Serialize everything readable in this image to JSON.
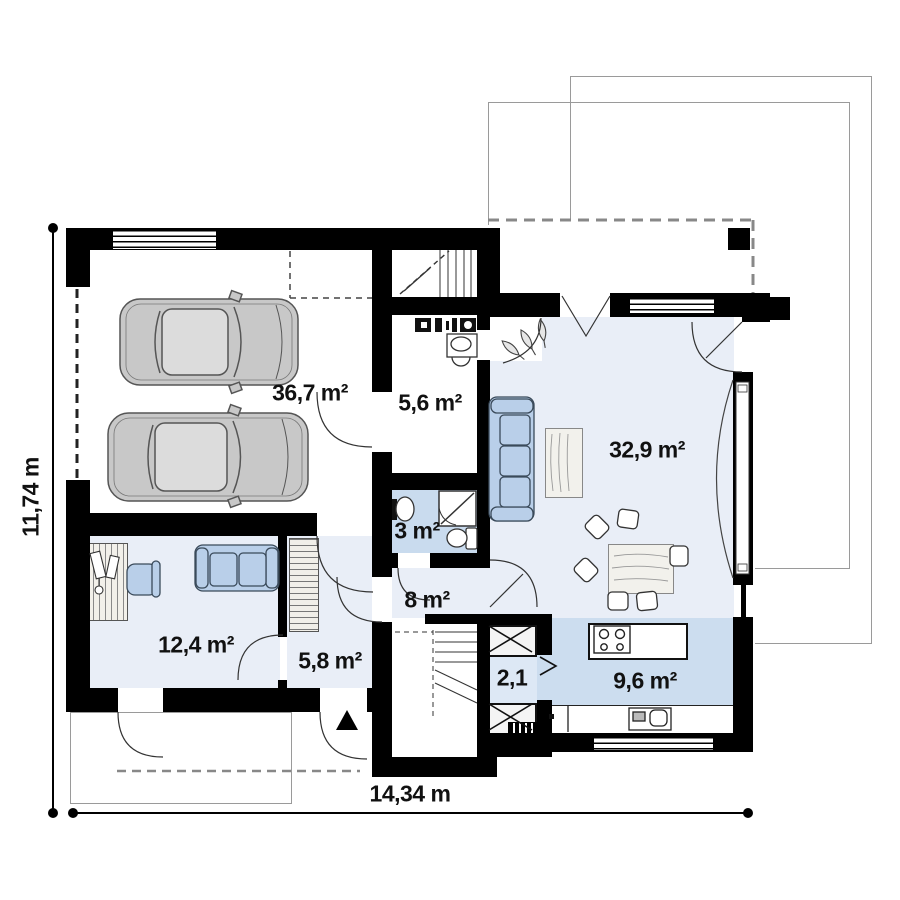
{
  "title": "House ground floor plan",
  "rooms": [
    {
      "id": "garage",
      "label": "36,7 m²"
    },
    {
      "id": "utility",
      "label": "5,6 m²"
    },
    {
      "id": "bathroom",
      "label": "3 m²"
    },
    {
      "id": "hall",
      "label": "8 m²"
    },
    {
      "id": "living",
      "label": "32,9 m²"
    },
    {
      "id": "office",
      "label": "12,4 m²"
    },
    {
      "id": "entry",
      "label": "5,8 m²"
    },
    {
      "id": "pantry",
      "label": "2,1"
    },
    {
      "id": "kitchen",
      "label": "9,6 m²"
    }
  ],
  "dimensions": {
    "height_label": "11,74 m",
    "width_label": "14,34 m"
  },
  "colors": {
    "wall": "#000000",
    "room_light": "#e9eef7",
    "room_medium": "#ccddef",
    "bathroom": "#c9dbee",
    "furniture_blue": "#b9cfe9",
    "car_gray": "#c8c8c8",
    "outline_gray": "#9a9a9a"
  }
}
